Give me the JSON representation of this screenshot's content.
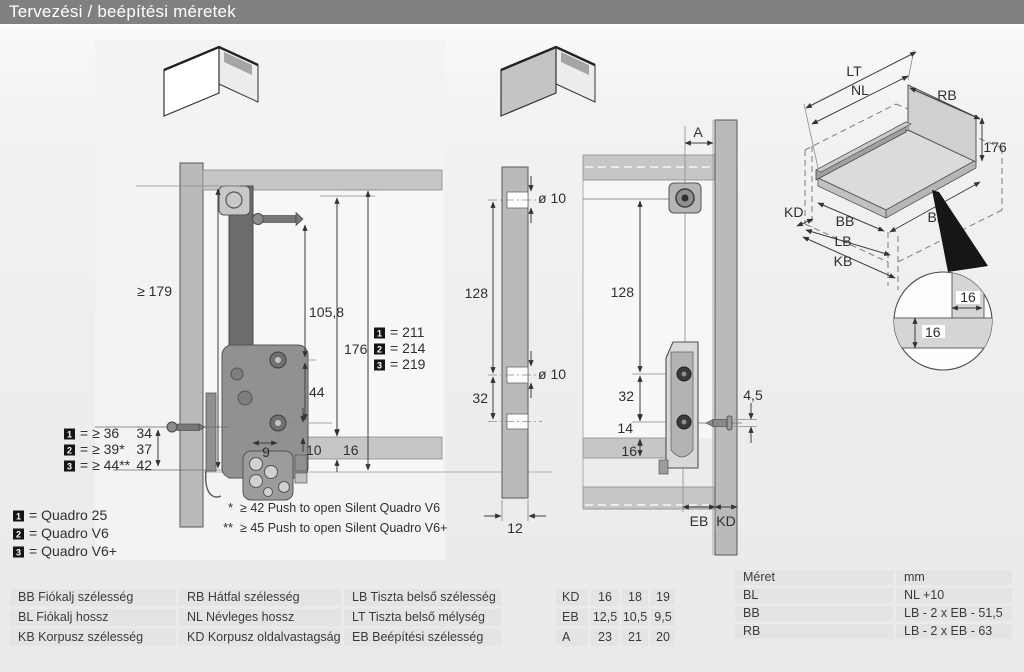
{
  "title": "Tervezési / beépítési méretek",
  "left": {
    "dim_179": "≥ 179",
    "dim_1058": "105,8",
    "dim_176": "176",
    "dim_44": "44",
    "dim_9": "9",
    "dim_10": "10",
    "dim_16": "16",
    "front_gaps": [
      {
        "n": "1",
        "text": "= ≥ 36",
        "value": "34"
      },
      {
        "n": "2",
        "text": "= ≥ 39*",
        "value": "37"
      },
      {
        "n": "3",
        "text": "= ≥ 44**",
        "value": "42"
      }
    ],
    "heights": [
      {
        "n": "1",
        "text": "= 211"
      },
      {
        "n": "2",
        "text": "= 214"
      },
      {
        "n": "3",
        "text": "= 219"
      }
    ]
  },
  "products": [
    {
      "n": "1",
      "text": "= Quadro 25"
    },
    {
      "n": "2",
      "text": "= Quadro V6"
    },
    {
      "n": "3",
      "text": "= Quadro V6+"
    }
  ],
  "footnotes": [
    {
      "mark": "*",
      "text": "≥ 42 Push to open Silent Quadro V6"
    },
    {
      "mark": "**",
      "text": "≥ 45 Push to open Silent Quadro V6+"
    }
  ],
  "middle": {
    "dia_top": "ø 10",
    "dia_mid": "ø 10",
    "dim_128": "128",
    "dim_32": "32",
    "dim_12": "12"
  },
  "right": {
    "dim_a": "A",
    "dim_128": "128",
    "dim_32": "32",
    "dim_14": "14",
    "dim_16": "16",
    "dim_45": "4,5",
    "label_eb": "EB",
    "label_kd": "KD"
  },
  "iso": {
    "lt": "LT",
    "nl": "NL",
    "rb": "RB",
    "dim_176": "176",
    "kd": "KD",
    "bb": "BB",
    "lb": "LB",
    "kb": "KB",
    "bl": "BL"
  },
  "detail": {
    "dim_16_width": "16",
    "dim_16_thickness": "16"
  },
  "tables": {
    "abbrev": {
      "rows": [
        [
          "BB Fiókalj szélesség",
          "RB Hátfal szélesség",
          "LB Tiszta belső szélesség"
        ],
        [
          "BL Fiókalj hossz",
          "NL Névleges hossz",
          "LT Tiszta belső mélység"
        ],
        [
          "KB Korpusz szélesség",
          "KD Korpusz oldalvastagságok",
          "EB Beépítési szélesség"
        ]
      ]
    },
    "values": {
      "rows": [
        [
          "KD",
          "16",
          "18",
          "19"
        ],
        [
          "EB",
          "12,5",
          "10,5",
          "9,5"
        ],
        [
          "A",
          "23",
          "21",
          "20"
        ]
      ]
    },
    "formulas": {
      "header": [
        "Méret",
        "mm"
      ],
      "rows": [
        [
          "BL",
          "NL +10"
        ],
        [
          "BB",
          "LB - 2 x EB - 51,5"
        ],
        [
          "RB",
          "LB - 2 x EB - 63"
        ]
      ]
    }
  }
}
